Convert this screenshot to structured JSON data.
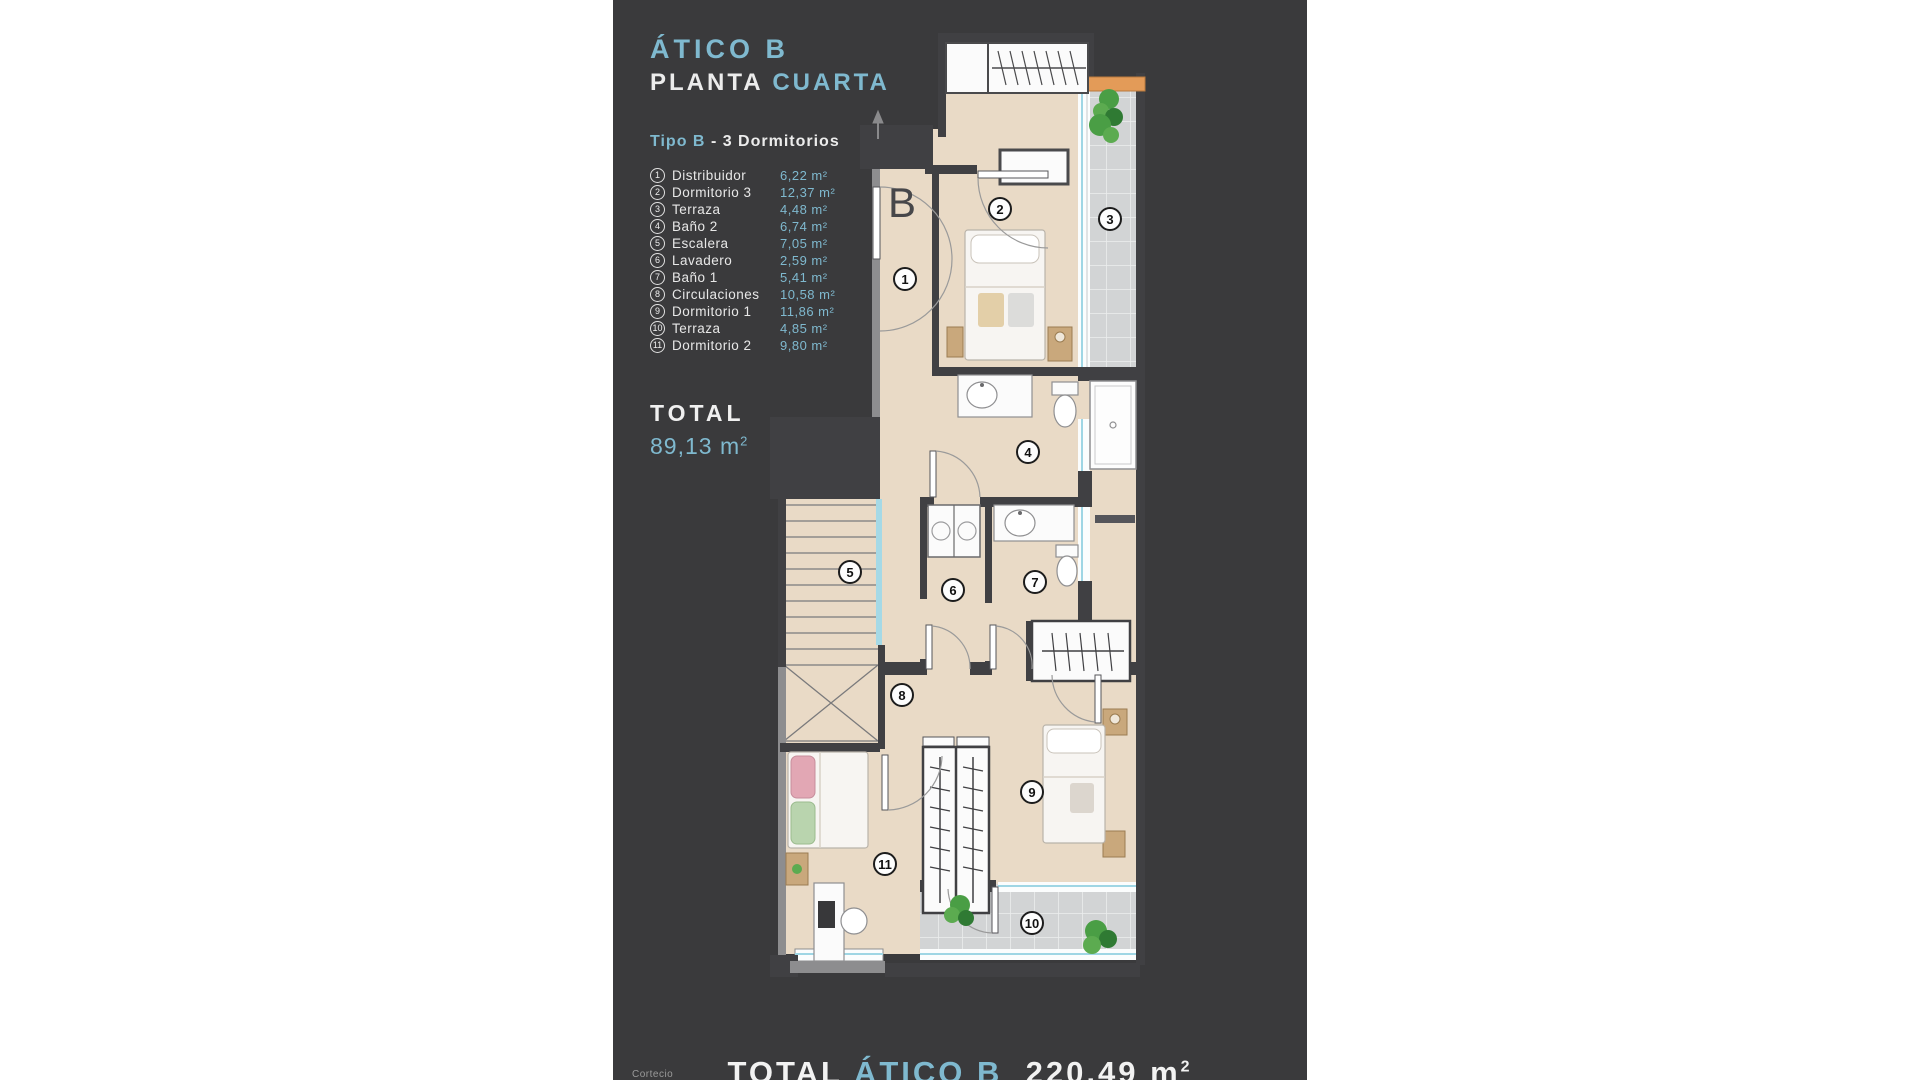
{
  "colors": {
    "panel_bg": "#3a3a3c",
    "accent": "#7fb9cf"
  },
  "header": {
    "title": "ÁTICO B",
    "plan_word": "PLANTA",
    "plan_floor": "CUARTA"
  },
  "type_line": {
    "highlight": "Tipo B",
    "rest": "- 3 Dormitorios"
  },
  "legend": {
    "items": [
      {
        "n": "1",
        "label": "Distribuidor",
        "area": "6,22 m²"
      },
      {
        "n": "2",
        "label": "Dormitorio 3",
        "area": "12,37 m²"
      },
      {
        "n": "3",
        "label": "Terraza",
        "area": "4,48 m²"
      },
      {
        "n": "4",
        "label": "Baño 2",
        "area": "6,74 m²"
      },
      {
        "n": "5",
        "label": "Escalera",
        "area": "7,05 m²"
      },
      {
        "n": "6",
        "label": "Lavadero",
        "area": "2,59 m²"
      },
      {
        "n": "7",
        "label": "Baño 1",
        "area": "5,41 m²"
      },
      {
        "n": "8",
        "label": "Circulaciones",
        "area": "10,58 m²"
      },
      {
        "n": "9",
        "label": "Dormitorio 1",
        "area": "11,86 m²"
      },
      {
        "n": "10",
        "label": "Terraza",
        "area": "4,85 m²"
      },
      {
        "n": "11",
        "label": "Dormitorio 2",
        "area": "9,80 m²"
      }
    ]
  },
  "total": {
    "label": "TOTAL",
    "value": "89,13 m",
    "sup": "2"
  },
  "plan": {
    "entrance_label": "B",
    "badges": [
      "1",
      "2",
      "3",
      "4",
      "5",
      "6",
      "7",
      "8",
      "9",
      "10",
      "11"
    ]
  },
  "footer": {
    "label": "TOTAL",
    "unit_name": "ÁTICO B",
    "value": "220,49 m",
    "sup": "2",
    "note": "Cortecio"
  }
}
